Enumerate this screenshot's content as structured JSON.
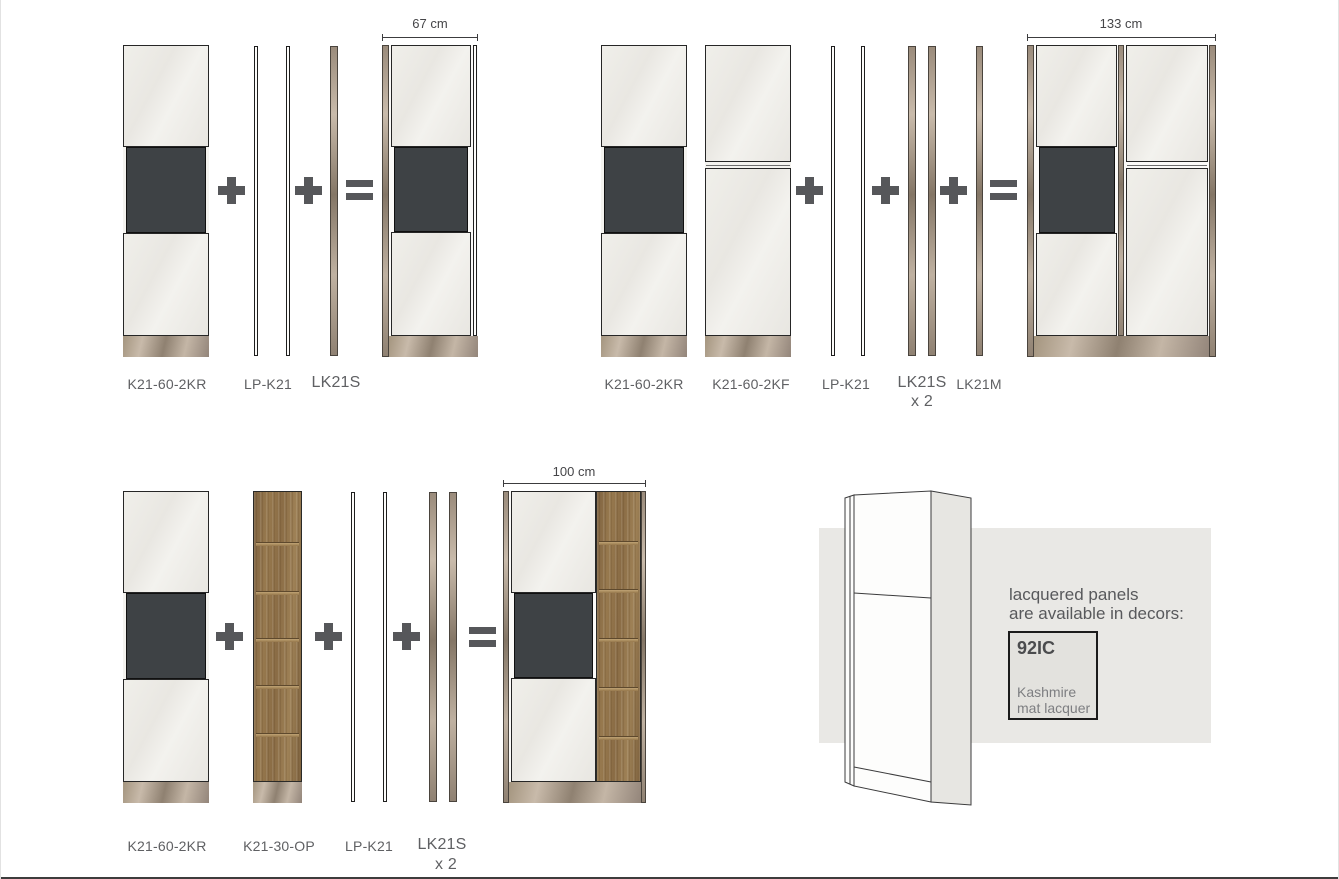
{
  "operators": {
    "plus": "+",
    "equals": "="
  },
  "combo1": {
    "result_width": "67 cm",
    "cabinet1_label": "K21-60-2KR",
    "panel_label": "LP-K21",
    "side_panel_label": "LK21S"
  },
  "combo2": {
    "result_width": "133 cm",
    "cabinet1_label": "K21-60-2KR",
    "cabinet2_label": "K21-60-2KF",
    "panel_label": "LP-K21",
    "side_panel_label": "LK21S",
    "side_panel_qty": "x 2",
    "mid_panel_label": "LK21M"
  },
  "combo3": {
    "result_width": "100 cm",
    "cabinet1_label": "K21-60-2KR",
    "cabinet2_label": "K21-30-OP",
    "panel_label": "LP-K21",
    "side_panel_label": "LK21S",
    "side_panel_qty": "x 2"
  },
  "info": {
    "heading_line1": "lacquered panels",
    "heading_line2": "are available in decors:",
    "decor_code": "92IC",
    "decor_name_line1": "Kashmire",
    "decor_name_line2": "mat lacquer"
  },
  "colors": {
    "door": "#ECEAE6",
    "dark_compartment": "#3E4245",
    "oak_wood": "#8F734F",
    "taupe_panel": "#A89A8B",
    "text_gray": "#5F6063",
    "operator_gray": "#56575A"
  }
}
